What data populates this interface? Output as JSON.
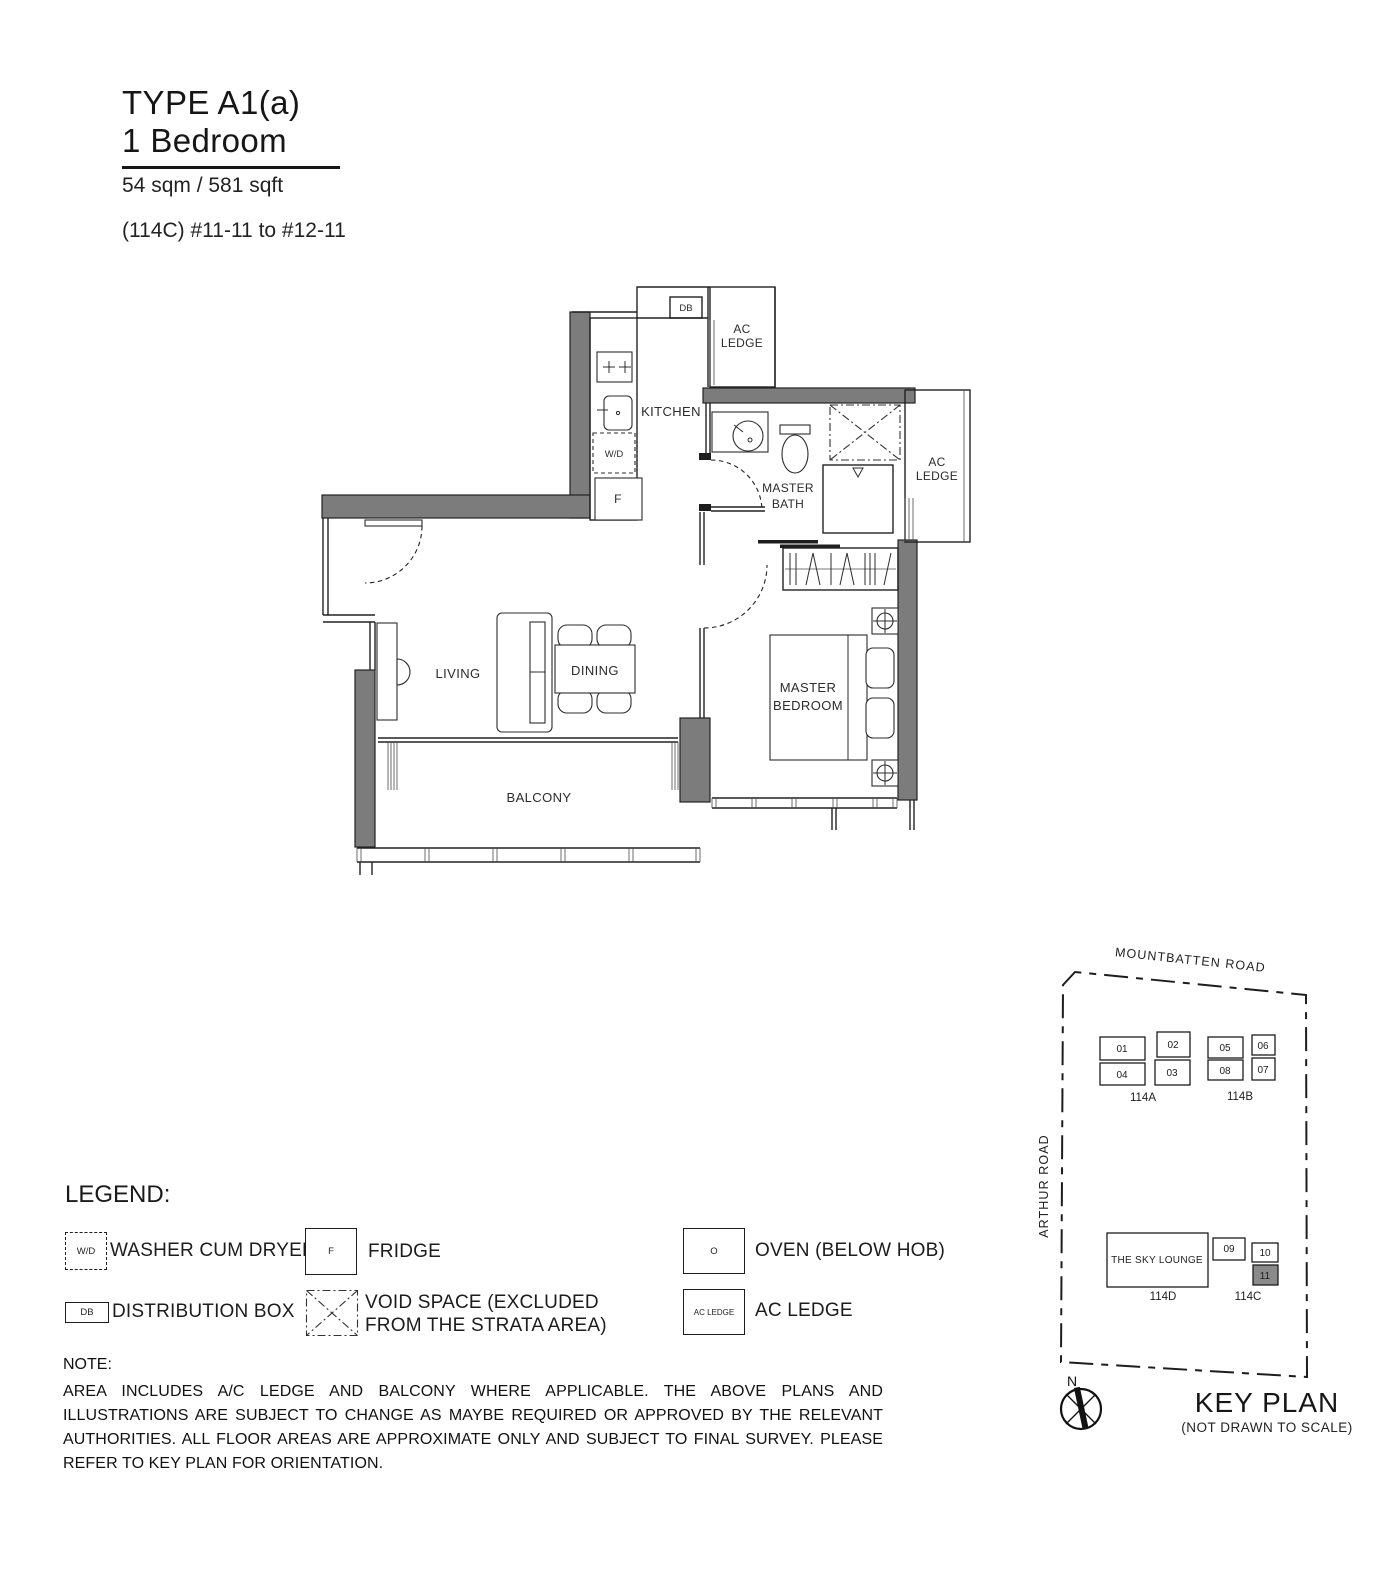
{
  "header": {
    "type_title": "TYPE A1(a)",
    "subtitle": "1 Bedroom",
    "area": "54 sqm / 581 sqft",
    "unit_range": "(114C) #11-11 to #12-11"
  },
  "floorplan": {
    "kitchen": "KITCHEN",
    "db": "DB",
    "wd": "W/D",
    "fridge": "F",
    "ac_l1": "AC",
    "ac_l2": "LEDGE",
    "bath_l1": "MASTER",
    "bath_l2": "BATH",
    "bed_l1": "MASTER",
    "bed_l2": "BEDROOM",
    "living": "LIVING",
    "dining": "DINING",
    "balcony": "BALCONY"
  },
  "legend": {
    "title": "LEGEND:",
    "wd_symbol": "W/D",
    "wd_label": "WASHER CUM DRYER",
    "fridge_symbol": "F",
    "fridge_label": "FRIDGE",
    "oven_symbol": "O",
    "oven_label": "OVEN (BELOW HOB)",
    "db_symbol": "DB",
    "db_label": "DISTRIBUTION BOX",
    "void_l1": "VOID SPACE (EXCLUDED",
    "void_l2": "FROM THE STRATA AREA)",
    "ac_symbol": "AC LEDGE",
    "ac_label": "AC LEDGE"
  },
  "note": {
    "title": "NOTE:",
    "body": "AREA INCLUDES A/C LEDGE AND BALCONY WHERE APPLICABLE. THE ABOVE PLANS AND ILLUSTRATIONS ARE SUBJECT TO CHANGE AS MAYBE REQUIRED OR APPROVED BY THE RELEVANT AUTHORITIES. ALL FLOOR AREAS ARE APPROXIMATE ONLY AND SUBJECT TO FINAL SURVEY. PLEASE REFER TO KEY PLAN FOR ORIENTATION."
  },
  "keyplan": {
    "road_top": "MOUNTBATTEN ROAD",
    "road_left": "ARTHUR ROAD",
    "units_a": [
      "01",
      "02",
      "04",
      "03"
    ],
    "units_b": [
      "05",
      "06",
      "08",
      "07"
    ],
    "units_c": [
      "09",
      "10",
      "11"
    ],
    "block_a": "114A",
    "block_b": "114B",
    "block_c": "114C",
    "block_d": "114D",
    "sky_lounge": "THE SKY LOUNGE",
    "highlighted_unit": "11",
    "north": "N",
    "title": "KEY PLAN",
    "subtitle": "(NOT DRAWN TO SCALE)"
  },
  "colors": {
    "wall_gray": "#7c7c7c",
    "line": "#222222",
    "keyplan_highlight": "#8a8a8a"
  }
}
